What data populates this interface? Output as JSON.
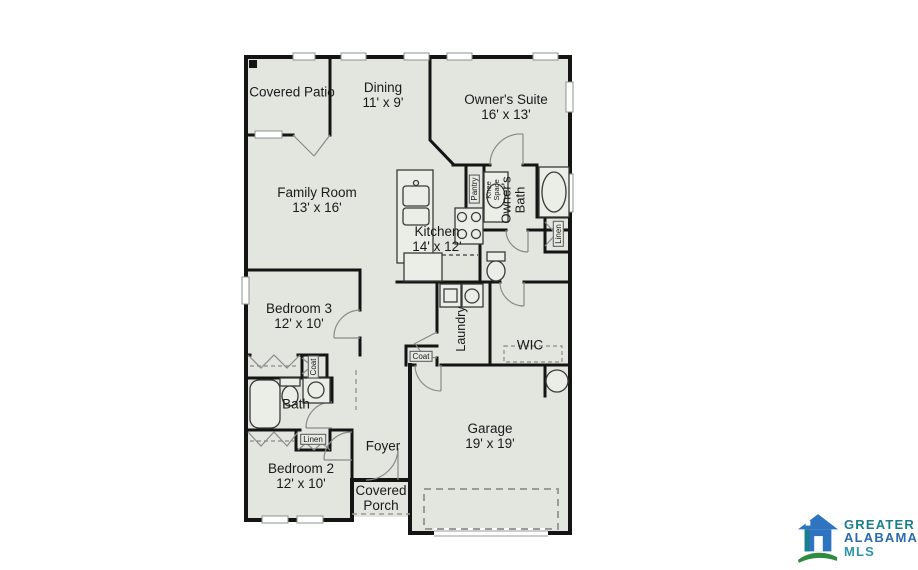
{
  "rooms": {
    "covered_patio": {
      "name": "Covered Patio"
    },
    "dining": {
      "name": "Dining",
      "dims": "11' x 9'"
    },
    "owners_suite": {
      "name": "Owner's Suite",
      "dims": "16' x 13'"
    },
    "family_room": {
      "name": "Family Room",
      "dims": "13' x 16'"
    },
    "kitchen": {
      "name": "Kitchen",
      "dims": "14' x 12'"
    },
    "owners_bath": {
      "name": "Owner's Bath"
    },
    "pantry": {
      "name": "Pantry"
    },
    "knee_space": {
      "name": "Knee Space"
    },
    "linen_owners": {
      "name": "Linen"
    },
    "bedroom3": {
      "name": "Bedroom 3",
      "dims": "12' x 10'"
    },
    "laundry": {
      "name": "Laundry"
    },
    "wic": {
      "name": "WIC"
    },
    "coat_bedroom": {
      "name": "Coat"
    },
    "coat_hall": {
      "name": "Coat"
    },
    "bath": {
      "name": "Bath"
    },
    "linen_hall": {
      "name": "Linen"
    },
    "bedroom2": {
      "name": "Bedroom 2",
      "dims": "12' x 10'"
    },
    "foyer": {
      "name": "Foyer"
    },
    "covered_porch": {
      "name": "Covered Porch"
    },
    "garage": {
      "name": "Garage",
      "dims": "19' x 19'"
    }
  },
  "logo": {
    "line1": "GREATER",
    "line2": "ALABAMA",
    "line3": "MLS"
  },
  "colors": {
    "floor_fill": "#e3e5df",
    "wall": "#141414",
    "logo_teal": "#1a7f8c",
    "logo_blue": "#2a6ab0",
    "logo_mls": "#2c93b0",
    "logo_green": "#2e8b3f"
  }
}
